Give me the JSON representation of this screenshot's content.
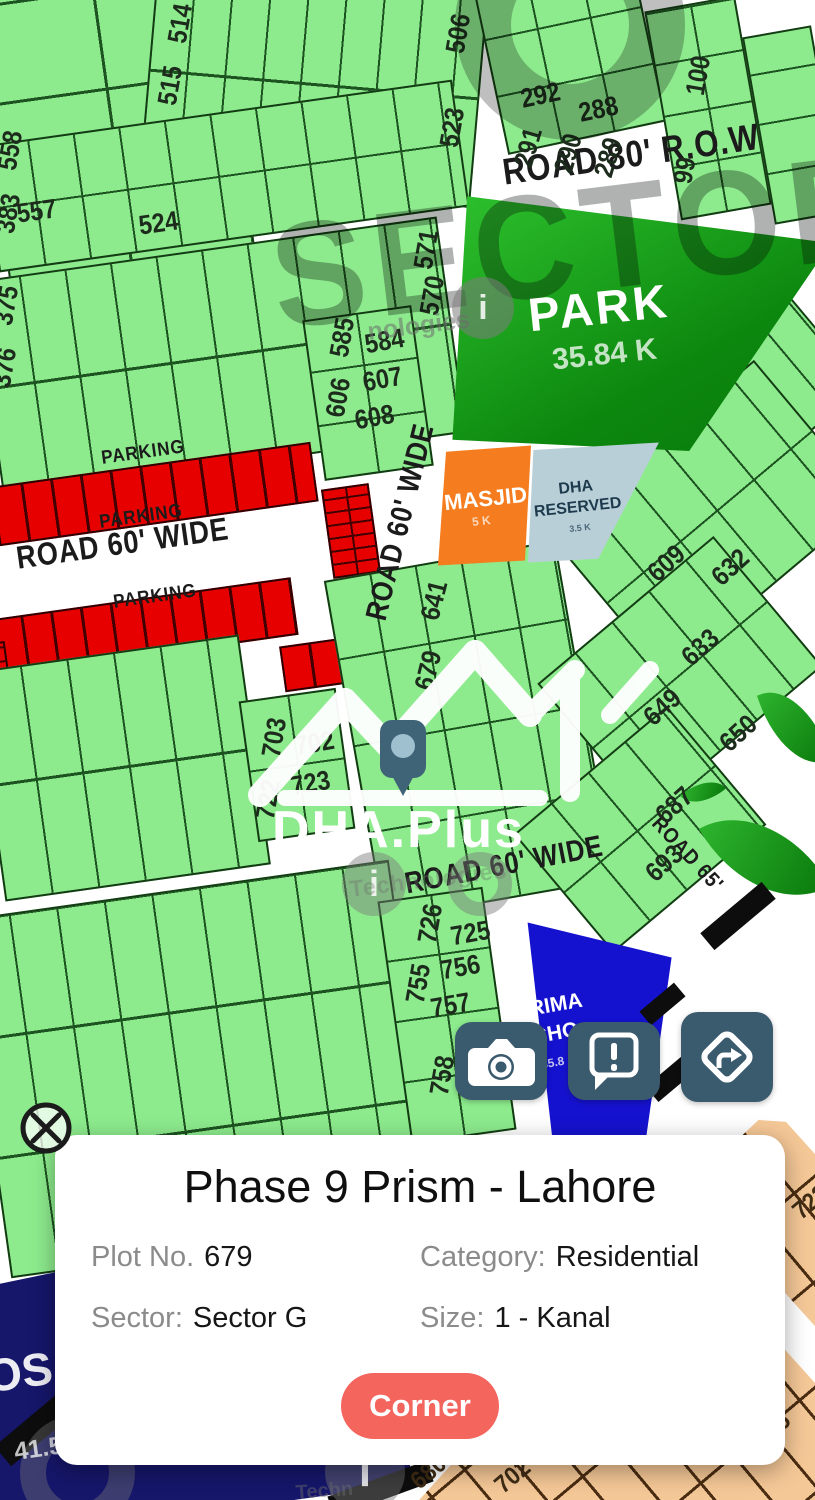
{
  "map": {
    "roads": [
      "ROAD 80' R.O.W",
      "ROAD 60' WIDE",
      "ROAD 60' WIDE",
      "ROAD 60' WIDE",
      "ROAD 65'",
      "PARKING",
      "PARKING",
      "PARKING"
    ],
    "plots": [
      "557",
      "524",
      "514",
      "515",
      "506",
      "523",
      "292",
      "288",
      "291",
      "290",
      "289",
      "100",
      "99",
      "558",
      "383",
      "375",
      "376",
      "571",
      "570",
      "585",
      "584",
      "607",
      "606",
      "608",
      "641",
      "679",
      "609",
      "632",
      "633",
      "649",
      "650",
      "687",
      "693",
      "703",
      "702",
      "722",
      "723",
      "726",
      "725",
      "756",
      "755",
      "757",
      "758",
      "723",
      "724",
      "735",
      "722",
      "680",
      "679",
      "702"
    ],
    "areas": {
      "park": {
        "name": "PARK",
        "size": "35.84 K"
      },
      "masjid": {
        "name": "MASJID",
        "size": "5 K"
      },
      "reserved": {
        "line1": "DHA",
        "line2": "RESERVED",
        "size": "3.5 K"
      },
      "school": {
        "line1": "PRIMA",
        "line2": "CHO",
        "size": "35.8"
      },
      "hospital": {
        "text": "OS",
        "size": "41.56 K"
      }
    },
    "watermarks": {
      "sector": "SECTOR",
      "brand": "DHA.Plus",
      "info": "i",
      "tech_top": "nologies",
      "tech_mid": "Technologies",
      "tech_bottom": "Techn"
    }
  },
  "actions": {
    "camera": "camera-icon",
    "report": "report-icon",
    "directions": "directions-icon"
  },
  "info_card": {
    "title": "Phase 9 Prism - Lahore",
    "fields": [
      {
        "label": "Plot No.",
        "value": "679"
      },
      {
        "label": "Category:",
        "value": "Residential"
      },
      {
        "label": "Sector:",
        "value": "Sector G"
      },
      {
        "label": "Size:",
        "value": "1 - Kanal"
      }
    ],
    "action_button": "Corner"
  },
  "colors": {
    "plot_green": "#8deb8d",
    "park_green": "#0e9212",
    "masjid_orange": "#f57d1f",
    "reserved_gray": "#b9cfd8",
    "parking_red": "#e60000",
    "school_blue": "#1512cf",
    "hospital_navy": "#16166b",
    "sector_tan": "#f5c897",
    "button_slate": "#3a5a6e",
    "corner_coral": "#f4655e"
  }
}
